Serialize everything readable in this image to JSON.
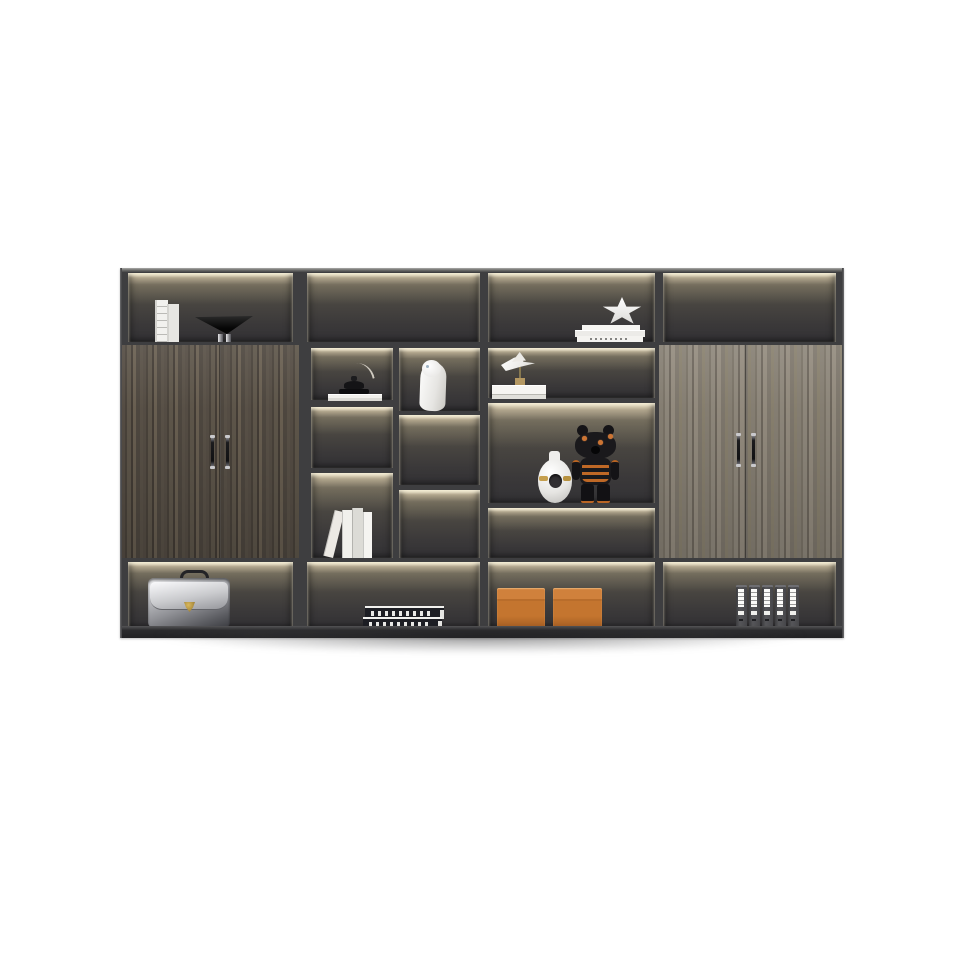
{
  "scene": {
    "type": "product-photo",
    "subject": "Modern charcoal office bookshelf wall unit with wood-grain doors and warm LED-lit open compartments",
    "background_color": "#ffffff"
  },
  "palette": {
    "frame": "#3e3e40",
    "plinth": "#2c2c2e",
    "led_glow": "#f6e7c2",
    "interior_dark": "#333235",
    "wood_left_dark": "#564e45",
    "wood_right_light": "#878074",
    "accent_orange": "#c4752f",
    "metal_chrome": "#c9c9cc",
    "gold": "#c59f4e"
  },
  "structure": {
    "columns": 4,
    "top_row_compartments": 4,
    "bottom_row_compartments": 4,
    "left_cabinet_doors": 2,
    "right_cabinet_doors": 2,
    "handle_count": 4
  },
  "items": {
    "cabinet": {
      "label": "Bookshelf wall unit"
    },
    "top_left_books": {
      "label": "Two white books standing upright",
      "count": 2
    },
    "cone_bowl": {
      "label": "Black cone bowl ornament on chrome feet"
    },
    "lamp_ornament": {
      "label": "Small black dome ornament on white books with leaf"
    },
    "white_sculpture": {
      "label": "Abstract white figure sculpture"
    },
    "paper_bird": {
      "label": "White bird ornament on wood stand and white book"
    },
    "star_sculpture": {
      "label": "White star ornament on stacked books"
    },
    "leaning_books": {
      "label": "Row of light books with one leaning",
      "count": 4
    },
    "donut_vase": {
      "label": "White ring vase with gold band"
    },
    "bear_figurine": {
      "label": "Black bear art toy with orange stripes and stars"
    },
    "briefcase": {
      "label": "Silver leather briefcase with gold clasp"
    },
    "book_stack": {
      "label": "Two stacked dark books with white spine lettering",
      "count": 2
    },
    "storage_boxes": {
      "label": "Two orange storage boxes",
      "count": 2
    },
    "binders": {
      "label": "Five dark ring binders with white labels",
      "count": 5
    },
    "left_doors": {
      "label": "Dark walnut double doors"
    },
    "right_doors": {
      "label": "Light grey-oak double doors"
    },
    "handles": {
      "label": "Vertical chrome-capped bar handle"
    }
  }
}
